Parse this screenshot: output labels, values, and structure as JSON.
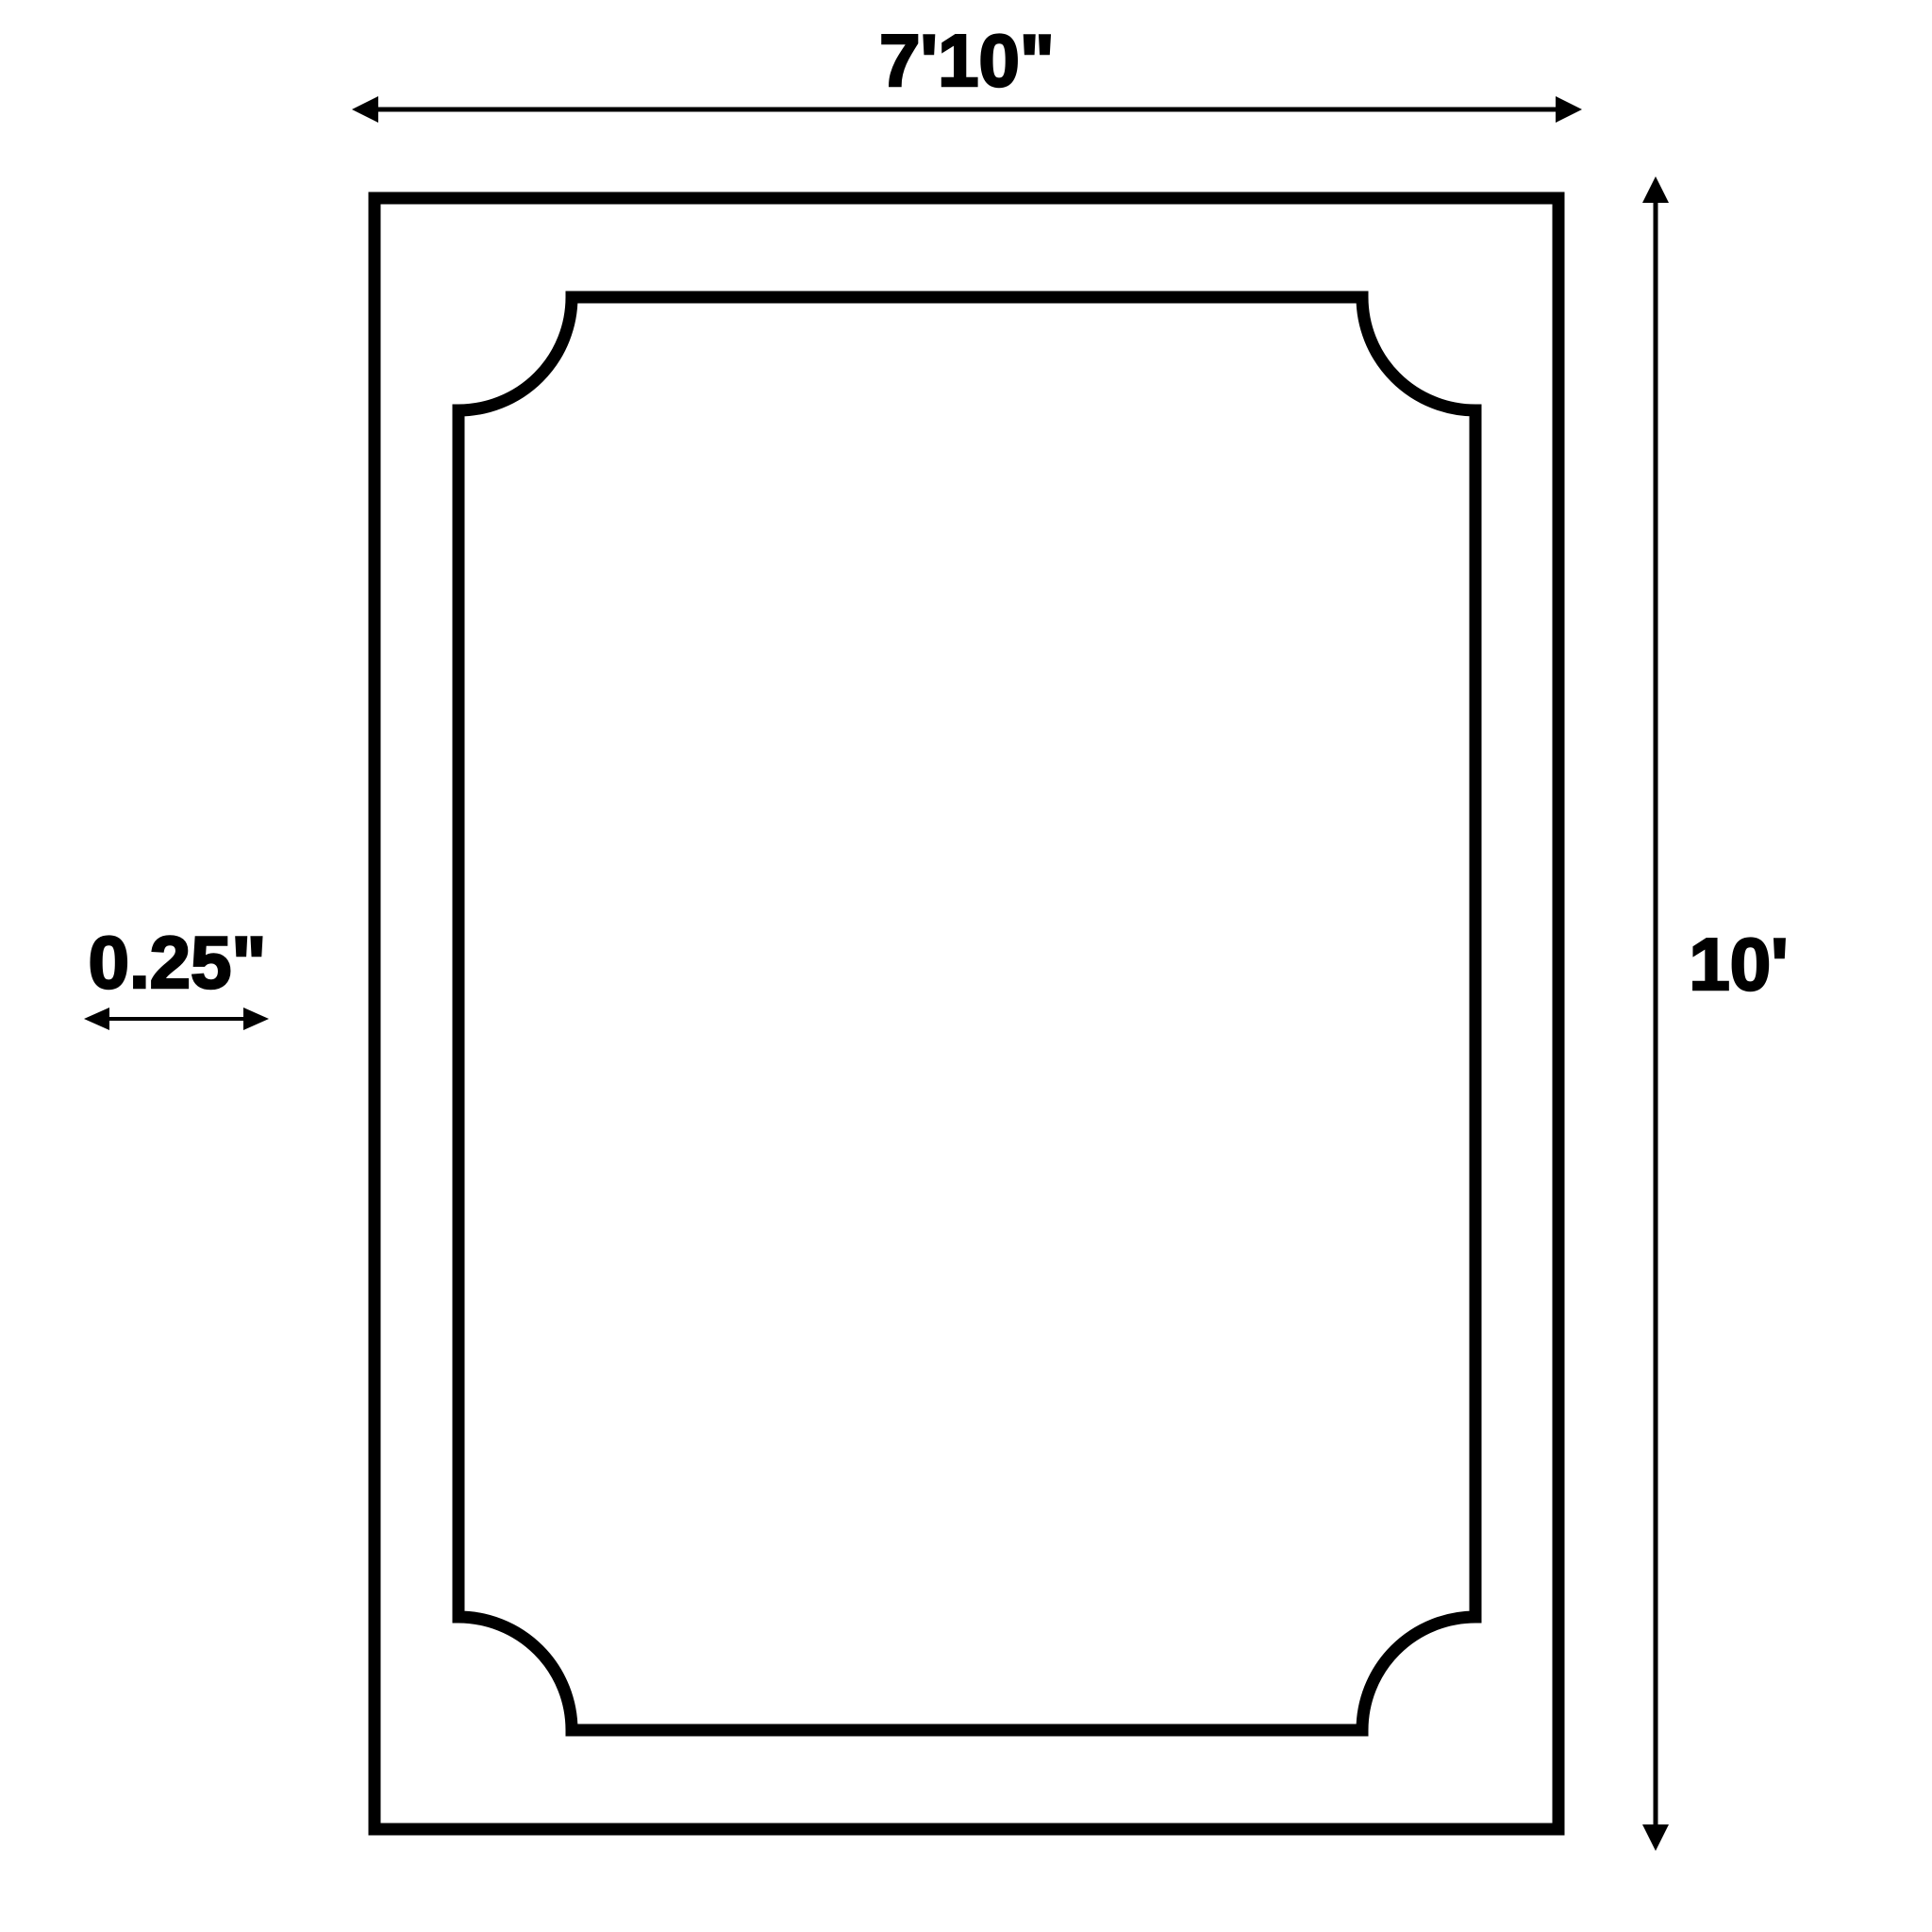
{
  "diagram": {
    "labels": {
      "width": "7'10\"",
      "height": "10'",
      "thickness": "0.25\""
    },
    "colors": {
      "stroke": "#000000",
      "background": "#ffffff"
    }
  }
}
